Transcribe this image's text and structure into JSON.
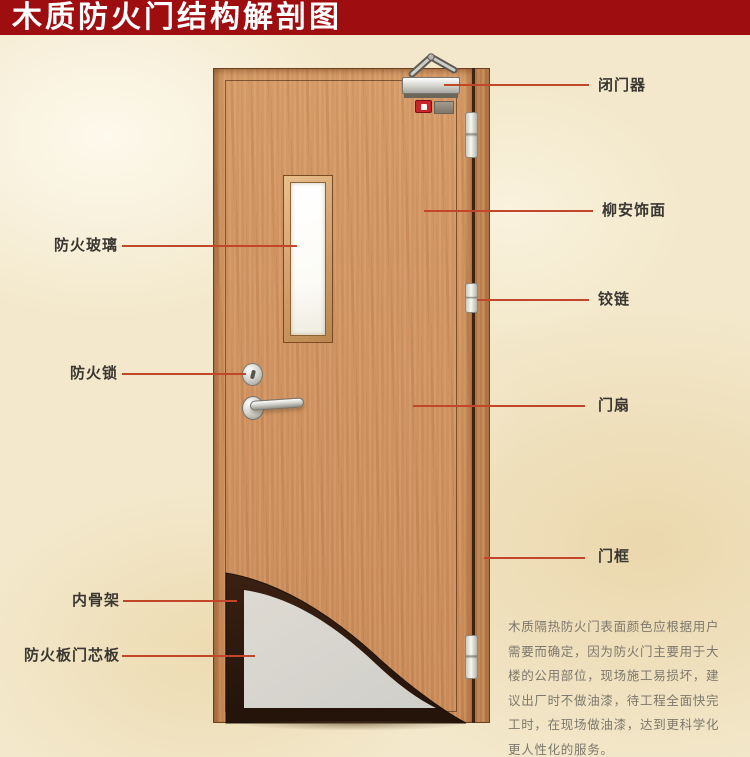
{
  "banner": {
    "title": "木质防火门结构解剖图"
  },
  "callouts": {
    "left": [
      {
        "id": "fire-glass",
        "label": "防火玻璃"
      },
      {
        "id": "fire-lock",
        "label": "防火锁"
      },
      {
        "id": "inner-skeleton",
        "label": "内骨架"
      },
      {
        "id": "fire-board-core",
        "label": "防火板门芯板"
      }
    ],
    "right": [
      {
        "id": "door-closer",
        "label": "闭门器"
      },
      {
        "id": "lauan-veneer",
        "label": "柳安饰面"
      },
      {
        "id": "hinge",
        "label": "铰链"
      },
      {
        "id": "door-leaf",
        "label": "门扇"
      },
      {
        "id": "door-frame",
        "label": "门框"
      }
    ]
  },
  "note": {
    "text": "木质隔热防火门表面颜色应根据用户需要而确定，因为防火门主要用于大楼的公用部位，现场施工易损坏，建议出厂时不做油漆，待工程全面快完工时，在现场做油漆，达到更科学化更人性化的服务。"
  },
  "colors": {
    "banner_bg": "#9E0D10",
    "banner_text": "#FFFFFF",
    "leader_line": "#C2462A",
    "label_text": "#3B3731",
    "note_text": "#7C786D",
    "background": "#F3E8CB",
    "wood": "#CE9260",
    "core_panel": "#D7D7D1",
    "skeleton": "#2C180E"
  }
}
